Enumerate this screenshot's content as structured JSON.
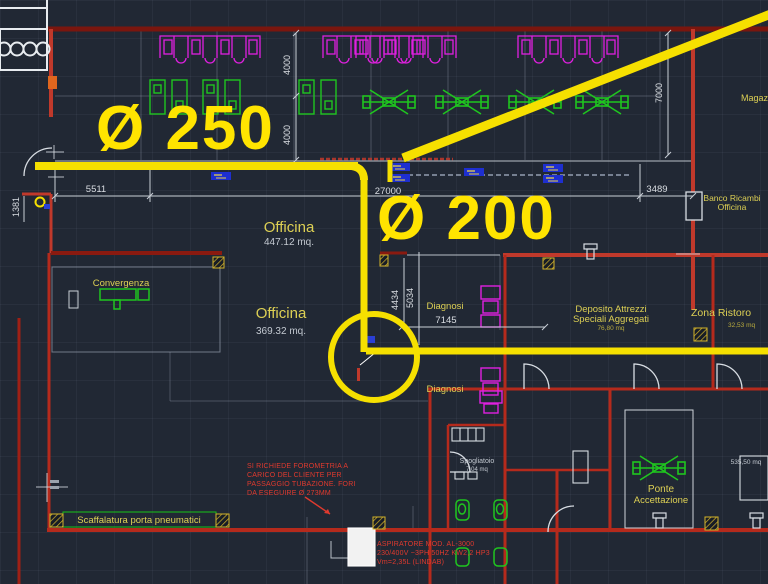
{
  "drawing": {
    "type": "cad-floor-plan",
    "pipes": {
      "label_250": "Ø 250",
      "label_200": "Ø 200"
    },
    "rooms": {
      "officina1": {
        "label": "Officina",
        "area": "447.12 mq."
      },
      "officina2": {
        "label": "Officina",
        "area": "369.32 mq."
      },
      "convergenza": {
        "label": "Convergenza"
      },
      "diagnosi1": {
        "label": "Diagnosi"
      },
      "diagnosi2": {
        "label": "Diagnosi"
      },
      "deposito": {
        "line1": "Deposito Attrezzi",
        "line2": "Speciali Aggregati",
        "area": "76,80 mq"
      },
      "zona_ristoro": {
        "label": "Zona Ristoro",
        "area": "32,53 mq"
      },
      "banco_ricambi": {
        "line1": "Banco Ricambi",
        "line2": "Officina"
      },
      "magazzino": {
        "label": "Magazzino"
      },
      "ponte": {
        "line1": "Ponte",
        "line2": "Accettazione"
      },
      "spogliatoio": {
        "label": "Spogliatoio",
        "area": "7,04 mq"
      },
      "scaffalatura": {
        "label": "Scaffalatura porta pneumatici"
      },
      "area_grande": {
        "area": "535,50 mq"
      }
    },
    "dimensions": {
      "w5511": "5511",
      "w27000": "27000",
      "w3489": "3489",
      "h4000a": "4000",
      "h4000b": "4000",
      "h7000": "7000",
      "h4434": "4434",
      "h5034": "5034",
      "w7145": "7145",
      "h1381": "1381"
    },
    "notes": {
      "forometria": {
        "l1": "SI RICHIEDE FOROMETRIA A",
        "l2": "CARICO DEL CLIENTE PER",
        "l3": "PASSAGGIO TUBAZIONE. FORI",
        "l4": "DA ESEGUIRE Ø 273MM"
      },
      "aspiratore": {
        "l1": "ASPIRATORE MOD. AL-3000",
        "l2": "230/400V ~3PH 50HZ KW2,2 HP3",
        "l3": "Vm=2,35L (LINDAB)"
      }
    },
    "colors": {
      "background": "#212834",
      "pipe_yellow": "#f6e000",
      "wall_red_bright": "#c0392b",
      "wall_red_dark": "#7a160e",
      "furniture_green": "#1fc51f",
      "equipment_magenta": "#e020e0",
      "dimension_white": "#d9dde2",
      "note_red": "#e03a2e",
      "label_yellow": "#ddd054",
      "selection_blue": "#1e2fd0"
    }
  }
}
